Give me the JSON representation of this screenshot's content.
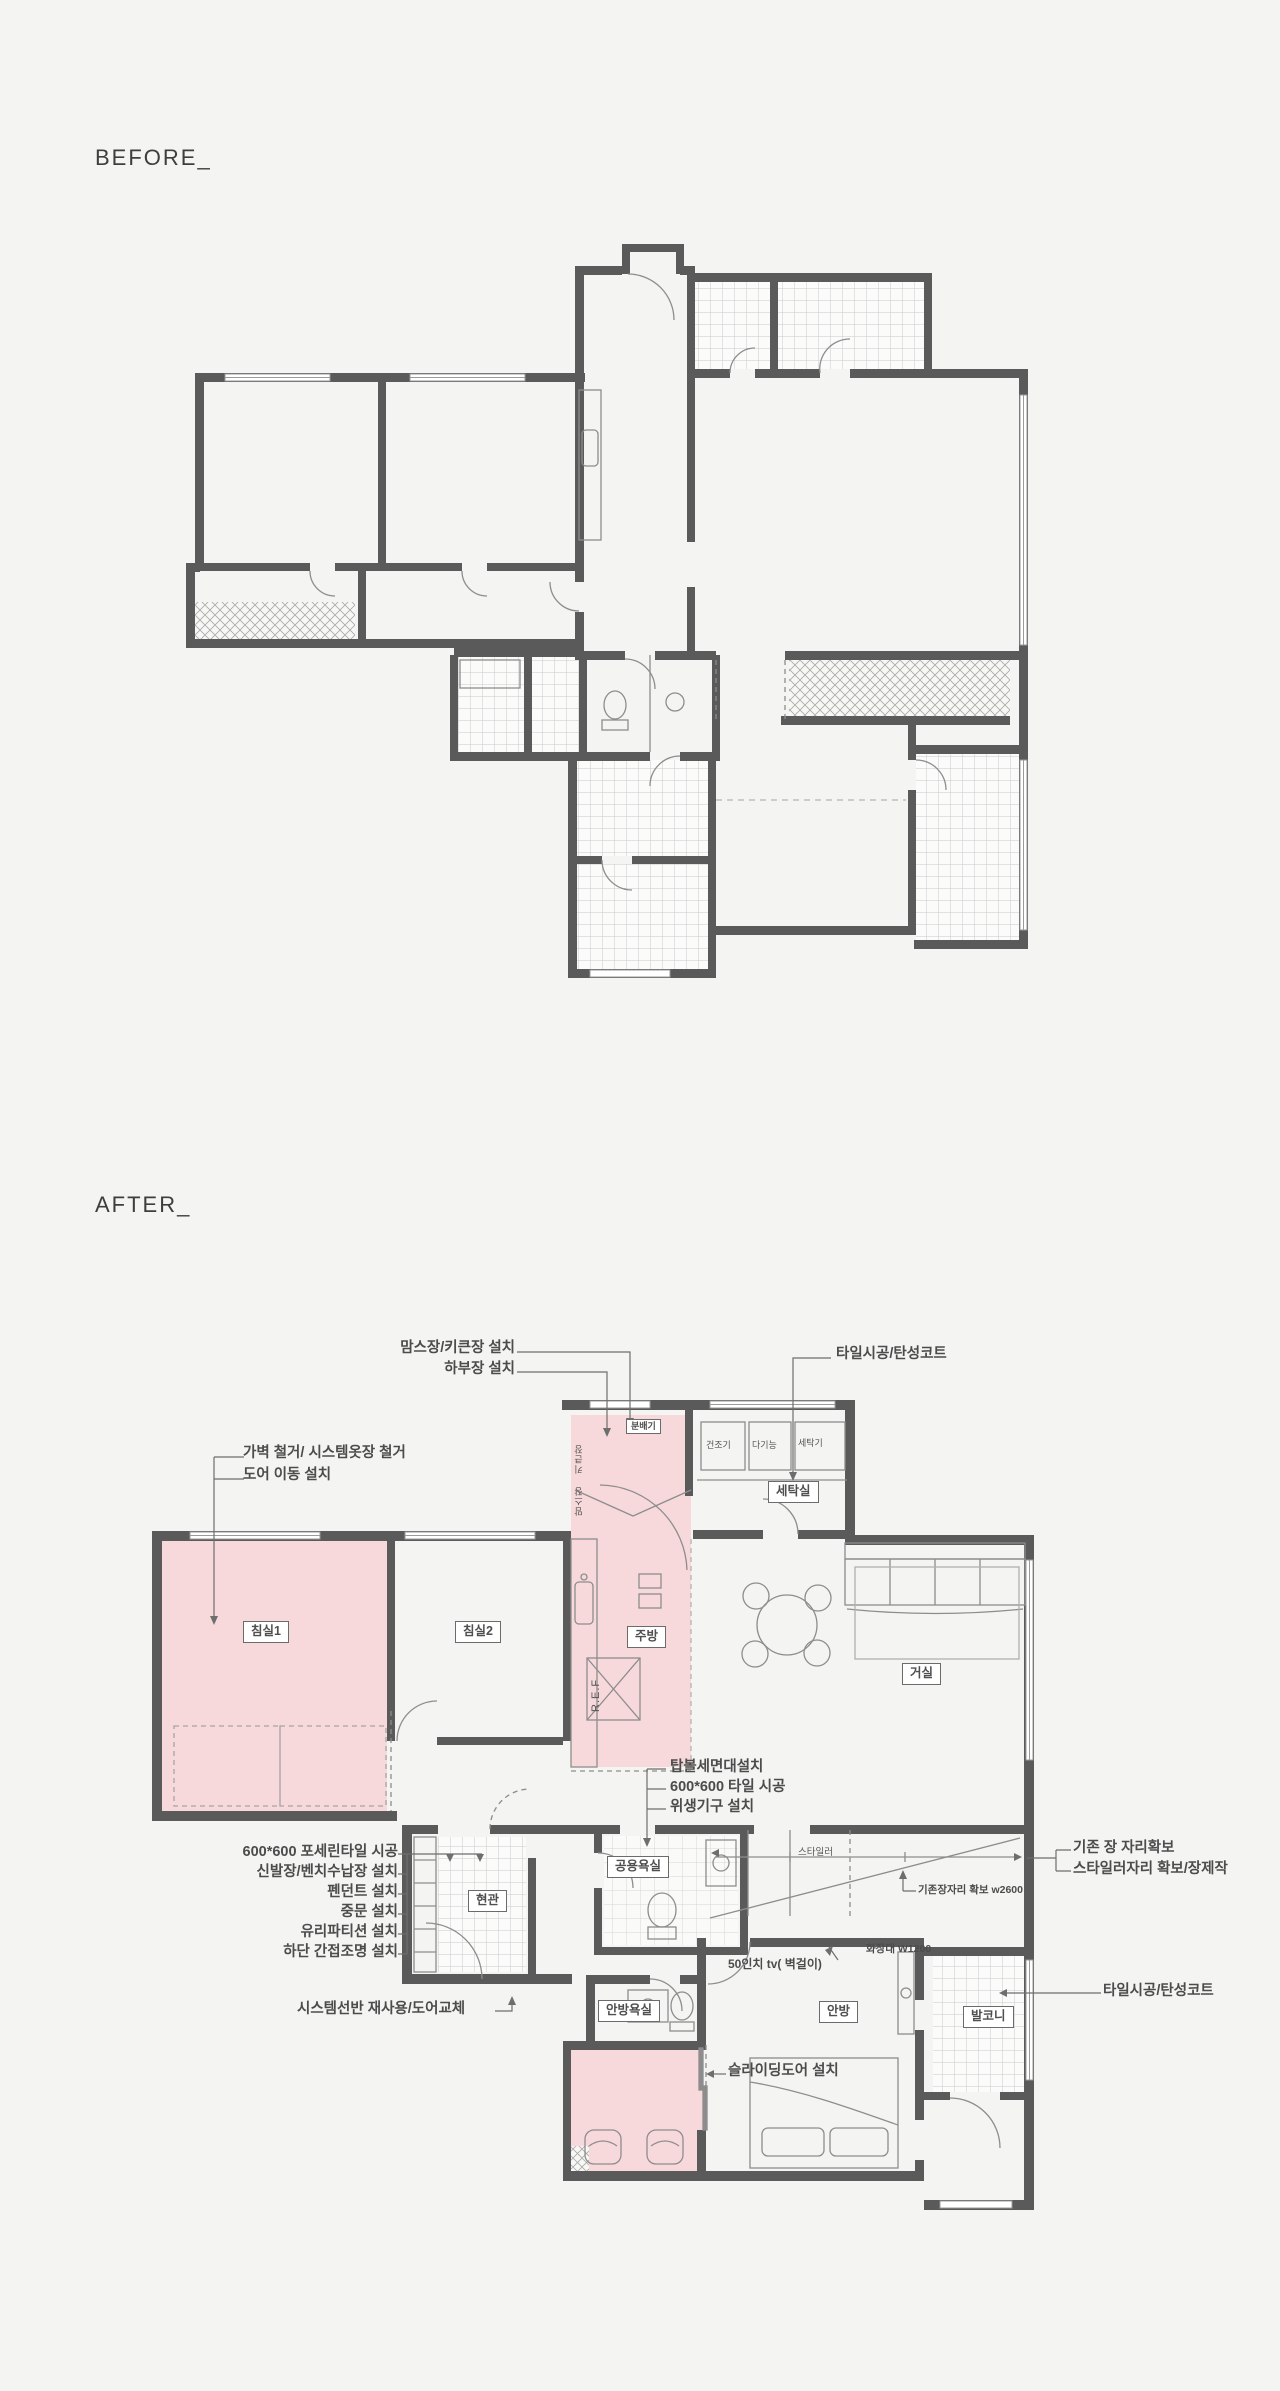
{
  "page": {
    "background": "#f4f4f2"
  },
  "before": {
    "title": "BEFORE_"
  },
  "after": {
    "title": "AFTER_",
    "colors": {
      "highlight": "#f8d9db",
      "wall": "#5a5a5a"
    },
    "rooms": {
      "bedroom1": "침실1",
      "bedroom2": "침실2",
      "kitchen": "주방",
      "living": "거실",
      "fridge": "R.E.F",
      "laundry": "세탁실",
      "entrance": "현관",
      "shared_bath": "공용욕실",
      "master_bath": "안방욕실",
      "master_bedroom": "안방",
      "balcony": "발코니",
      "distributor": "분배기",
      "tall_cabinet": "키큰장",
      "moms_cabinet": "맘스장",
      "dryer": "건조기",
      "aux_unit": "다기능",
      "washer": "세탁기",
      "styler": "스타일러"
    },
    "annotations": {
      "pantry_upper": "맘스장/키큰장 설치",
      "pantry_lower": "하부장 설치",
      "laundry_tile": "타일시공/탄성코트",
      "bedroom_demo1": "가벽 철거/ 시스템옷장 철거",
      "bedroom_demo2": "도어 이동 설치",
      "bath1": "탑볼세면대설치",
      "bath2": "600*600 타일 시공",
      "bath3": "위생기구 설치",
      "entry1": "600*600 포세린타일 시공",
      "entry2": "신발장/벤치수납장 설치",
      "entry3": "펜던트 설치",
      "entry4": "중문 설치",
      "entry5": "유리파티션 설치",
      "entry6": "하단 간접조명 설치",
      "closet_keep1": "기존 장 자리확보",
      "closet_keep2": "스타일러자리 확보/장제작",
      "closet_dim": "기존장자리 확보 w2600",
      "tv": "50인치 tv( 벽걸이)",
      "dresser": "화장대 W1200",
      "balcony_tile": "타일시공/탄성코트",
      "shelf_reuse": "시스템선반 재사용/도어교체",
      "sliding_door": "슬라이딩도어 설치"
    }
  }
}
